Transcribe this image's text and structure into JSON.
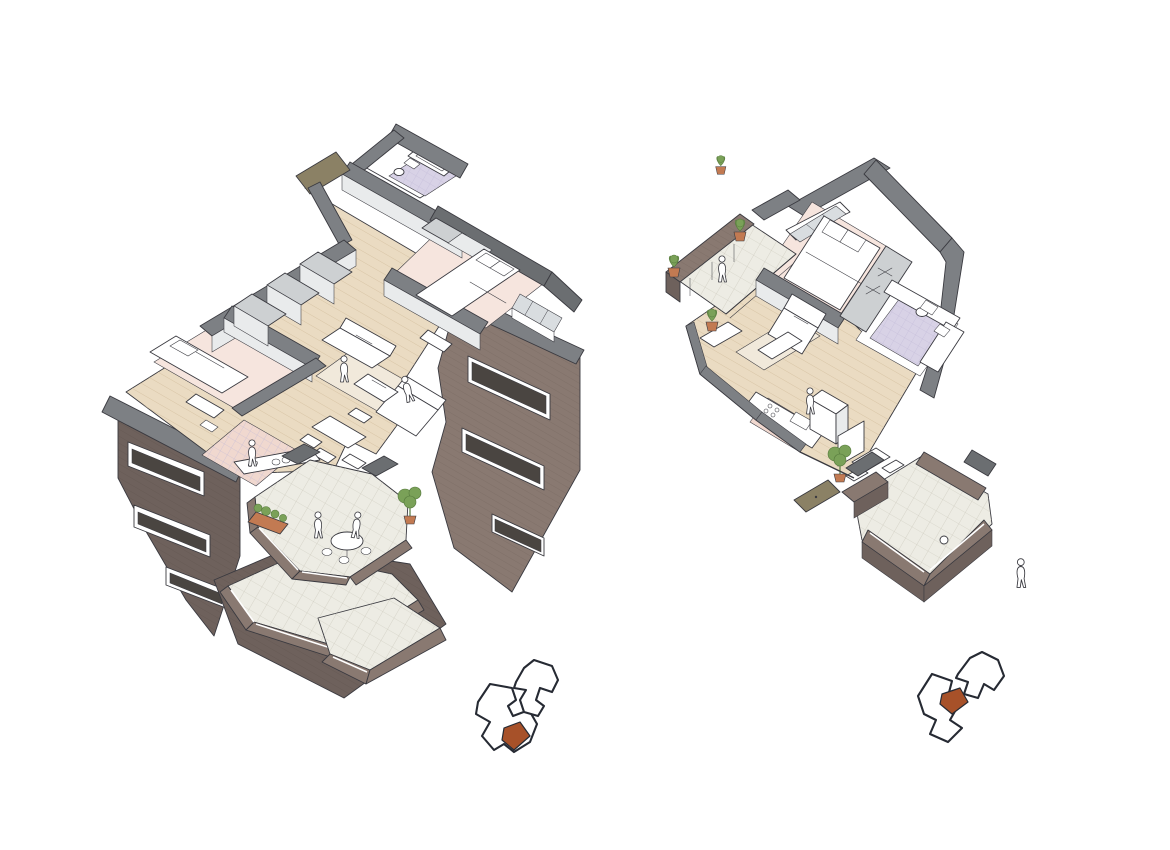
{
  "page": {
    "background": "#ffffff"
  },
  "colors": {
    "paper": "#ffffff",
    "ink": "#3a3a40",
    "brick": "#897971",
    "brickDark": "#6e615c",
    "cap": "#7d8084",
    "capDark": "#6b6e71",
    "wood": "#eadbc2",
    "woodLine": "#d3bf9f",
    "pink": "#f6e5de",
    "pinkDeep": "#f0d8cf",
    "lavender": "#d8d2e6",
    "lavLine": "#c0b8d6",
    "terrace": "#edece4",
    "terraceLine": "#c8c5b8",
    "glass": "#d9dde0",
    "windowDark": "#4a4541",
    "wallLight": "#e9ebec",
    "wallFace": "#cdd0d2",
    "rug": "#f1e9db",
    "olive": "#8b8165",
    "plant": "#7aa158",
    "plantDark": "#55793c",
    "pot": "#c27a52",
    "keyOutline": "#262a33",
    "keyHighlight": "#a75129"
  },
  "figures": {
    "left_axon": {
      "label": "large-corner-apartment-axonometric-cutaway"
    },
    "right_axon": {
      "label": "one-bedroom-apartment-axonometric-cutaway"
    },
    "key_plan_left": {
      "label": "site-key-plan-unit-low"
    },
    "key_plan_right": {
      "label": "site-key-plan-unit-mid"
    }
  }
}
